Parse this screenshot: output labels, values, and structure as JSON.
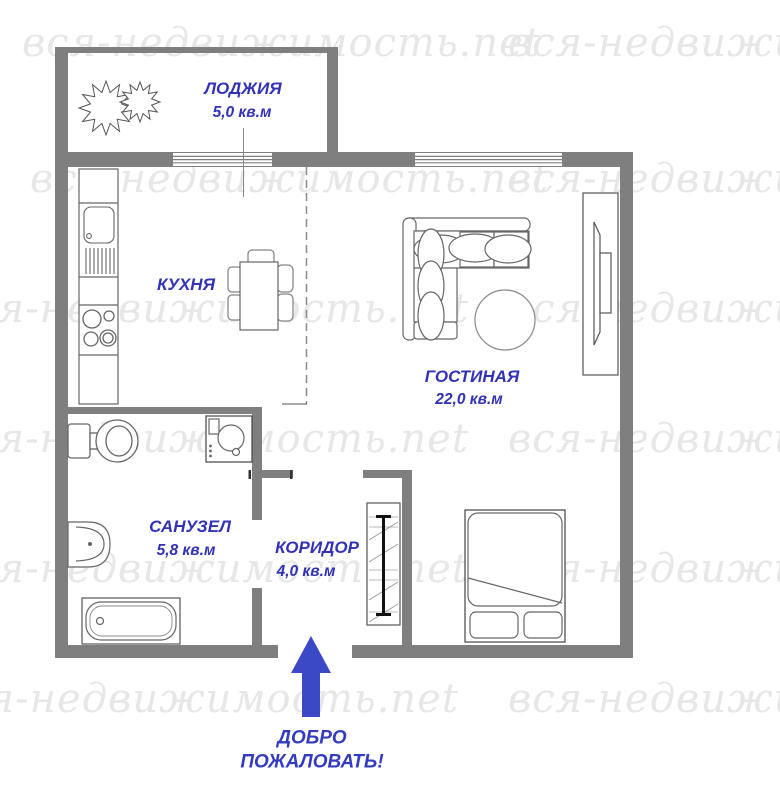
{
  "title": "Floor plan of one-room apartment",
  "watermark": {
    "text": "вся-недвижимость.net"
  },
  "colors": {
    "wall_gray": "#7f7f7f",
    "label_blue": "#3132b4",
    "welcome_blue": "#333cc0",
    "arrow_blue": "#3c49c6",
    "watermark_gray": "#e7e7e7",
    "furniture_stroke": "#666666"
  },
  "rooms": {
    "loggia": {
      "name": "ЛОДЖИЯ",
      "area": "5,0 кв.м"
    },
    "kitchen": {
      "name": "КУХНЯ"
    },
    "living": {
      "name": "ГОСТИНАЯ",
      "area": "22,0 кв.м"
    },
    "bathroom": {
      "name": "САНУЗЕЛ",
      "area": "5,8 кв.м"
    },
    "corridor": {
      "name": "КОРИДОР",
      "area": "4,0 кв.м"
    }
  },
  "entrance": {
    "welcome_line1": "ДОБРО",
    "welcome_line2": "ПОЖАЛОВАТЬ!"
  },
  "furniture": [
    "kitchen-counter",
    "sink",
    "stove",
    "dining-table",
    "chairs",
    "corner-sofa",
    "round-table",
    "tv-stand",
    "bed",
    "wardrobe",
    "toilet",
    "washing-machine",
    "wash-basin",
    "bathtub",
    "plants"
  ]
}
